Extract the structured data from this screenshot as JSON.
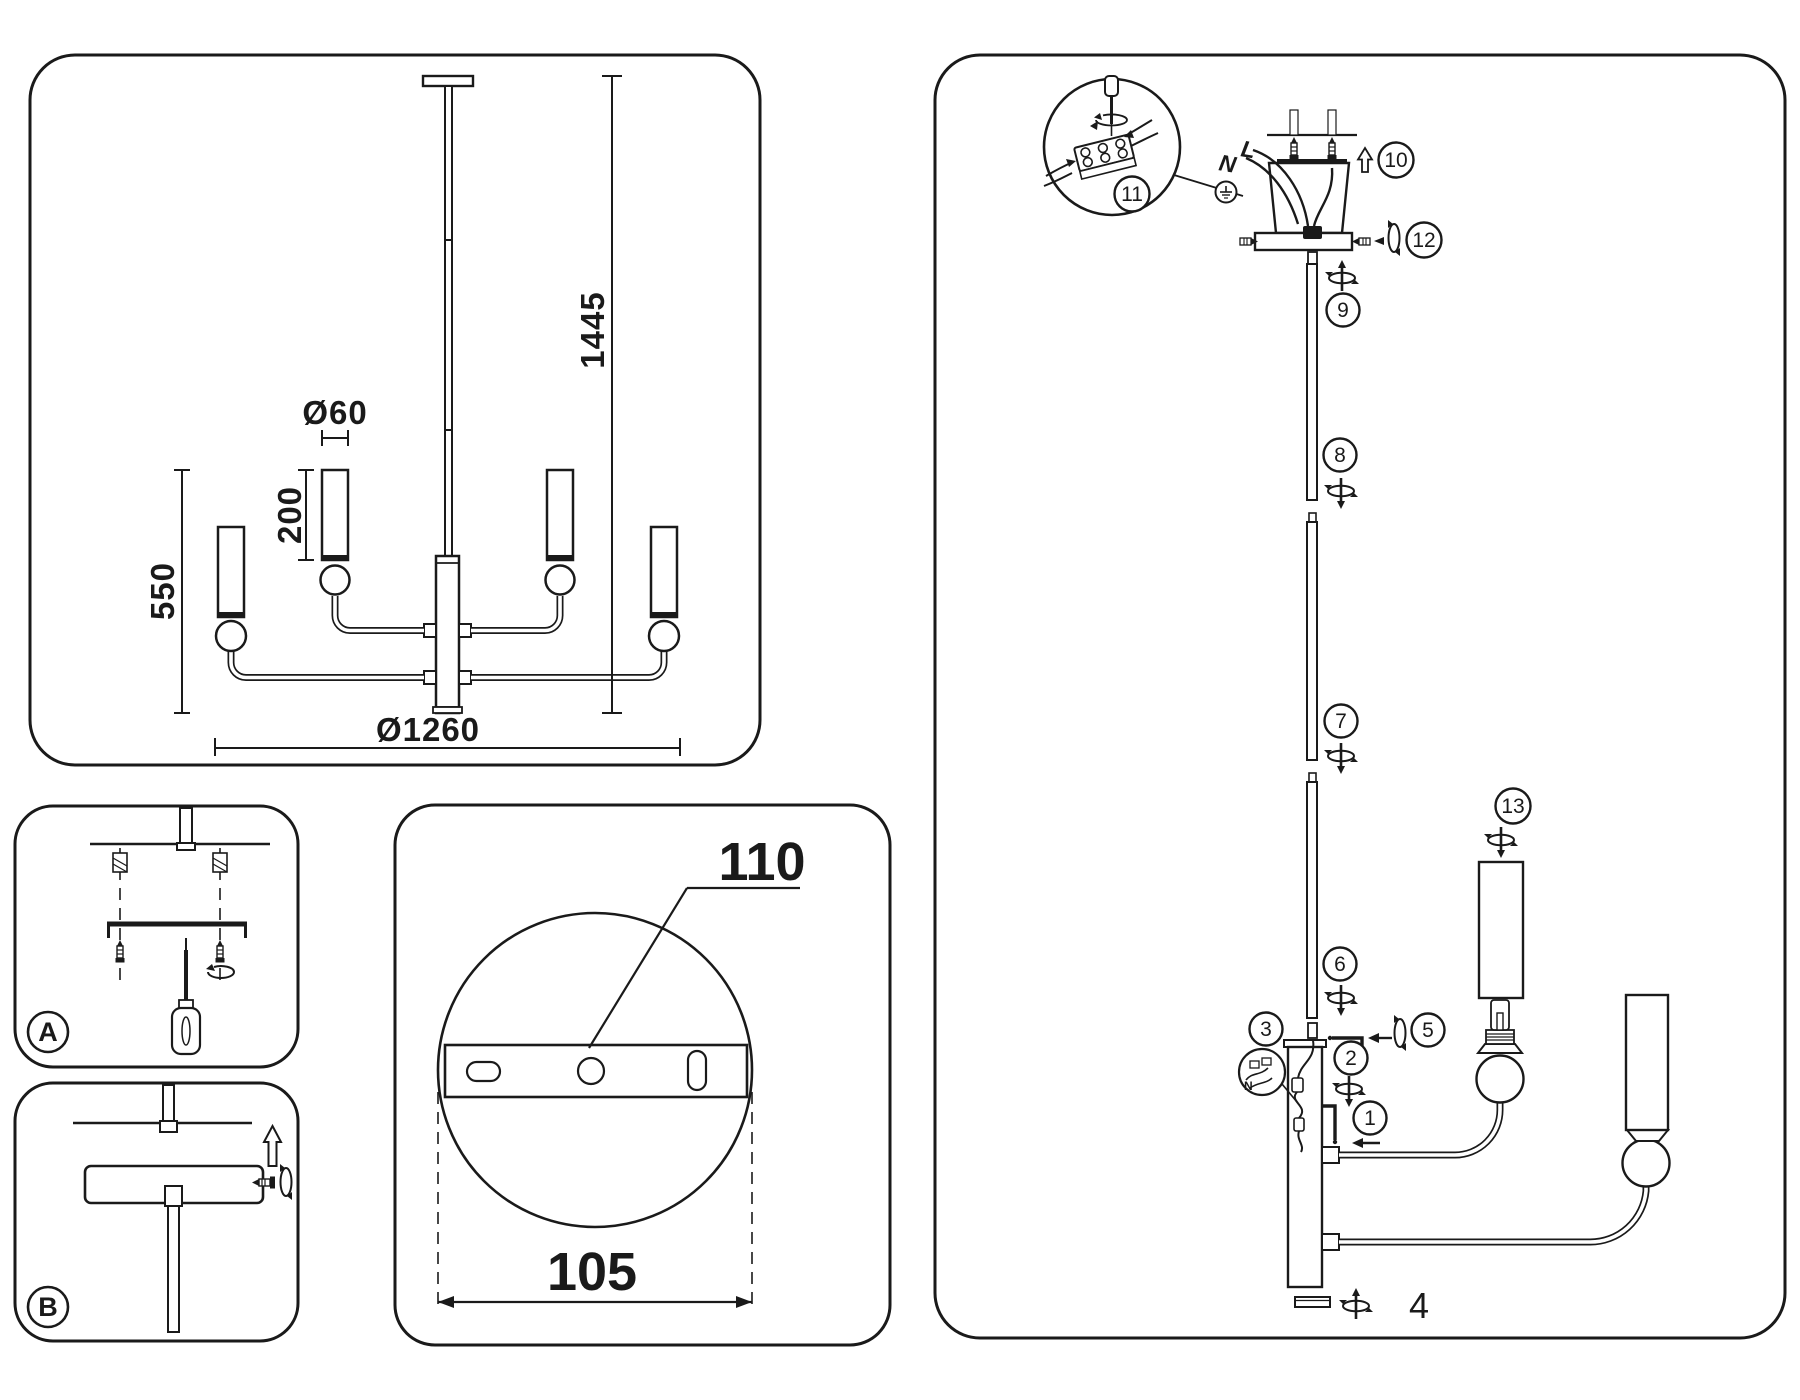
{
  "document": {
    "kind": "chandelier installation diagram",
    "stroke_color": "#1a1a1a",
    "background_color": "#ffffff"
  },
  "overview_panel": {
    "dim_shade_diameter": "Ø60",
    "dim_shade_height": "200",
    "dim_body_height": "550",
    "dim_total_height": "1445",
    "dim_total_diameter": "Ø1260"
  },
  "plate_panel": {
    "dim_hole": "110",
    "dim_spacing": "105"
  },
  "mount_panel_a": {
    "label": "A"
  },
  "mount_panel_b": {
    "label": "B"
  },
  "assembly_panel": {
    "steps": [
      "1",
      "2",
      "3",
      "4",
      "5",
      "6",
      "7",
      "8",
      "9",
      "10",
      "11",
      "12",
      "13"
    ],
    "wire_neutral": "N",
    "wire_live": "L"
  }
}
